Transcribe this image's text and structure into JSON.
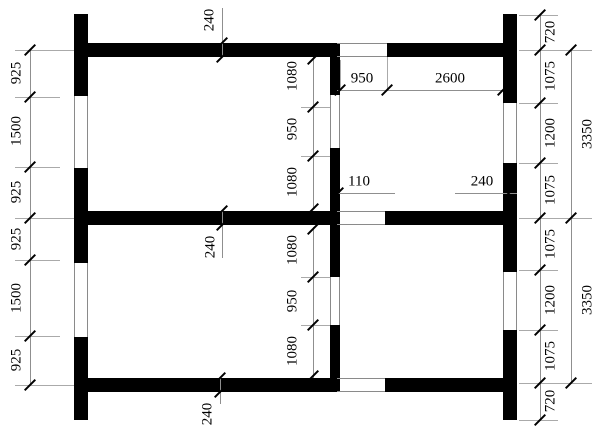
{
  "drawing": {
    "description": "Architectural wall plan, 2x2 rooms, black walls with openings",
    "background_color": "#ffffff",
    "wall_color": "#000000",
    "line_color": "#8a8a8a"
  },
  "dims": {
    "left_chain": [
      "925",
      "1500",
      "925",
      "925",
      "1500",
      "925"
    ],
    "right_chain": [
      "720",
      "1075",
      "1200",
      "1075",
      "1075",
      "1200",
      "1075",
      "720"
    ],
    "right_total_top": "3350",
    "right_total_bottom": "3350",
    "top_wall_thickness": "240",
    "middle_wall_thickness": "240",
    "bottom_wall_thickness": "240",
    "interior_chain_upper": [
      "1080",
      "950",
      "1080"
    ],
    "interior_chain_lower": [
      "1080",
      "950",
      "1080"
    ],
    "room_opening_width": "950",
    "room_wall_run": "2600",
    "room_offset": "110",
    "room_wall_thickness": "240"
  }
}
